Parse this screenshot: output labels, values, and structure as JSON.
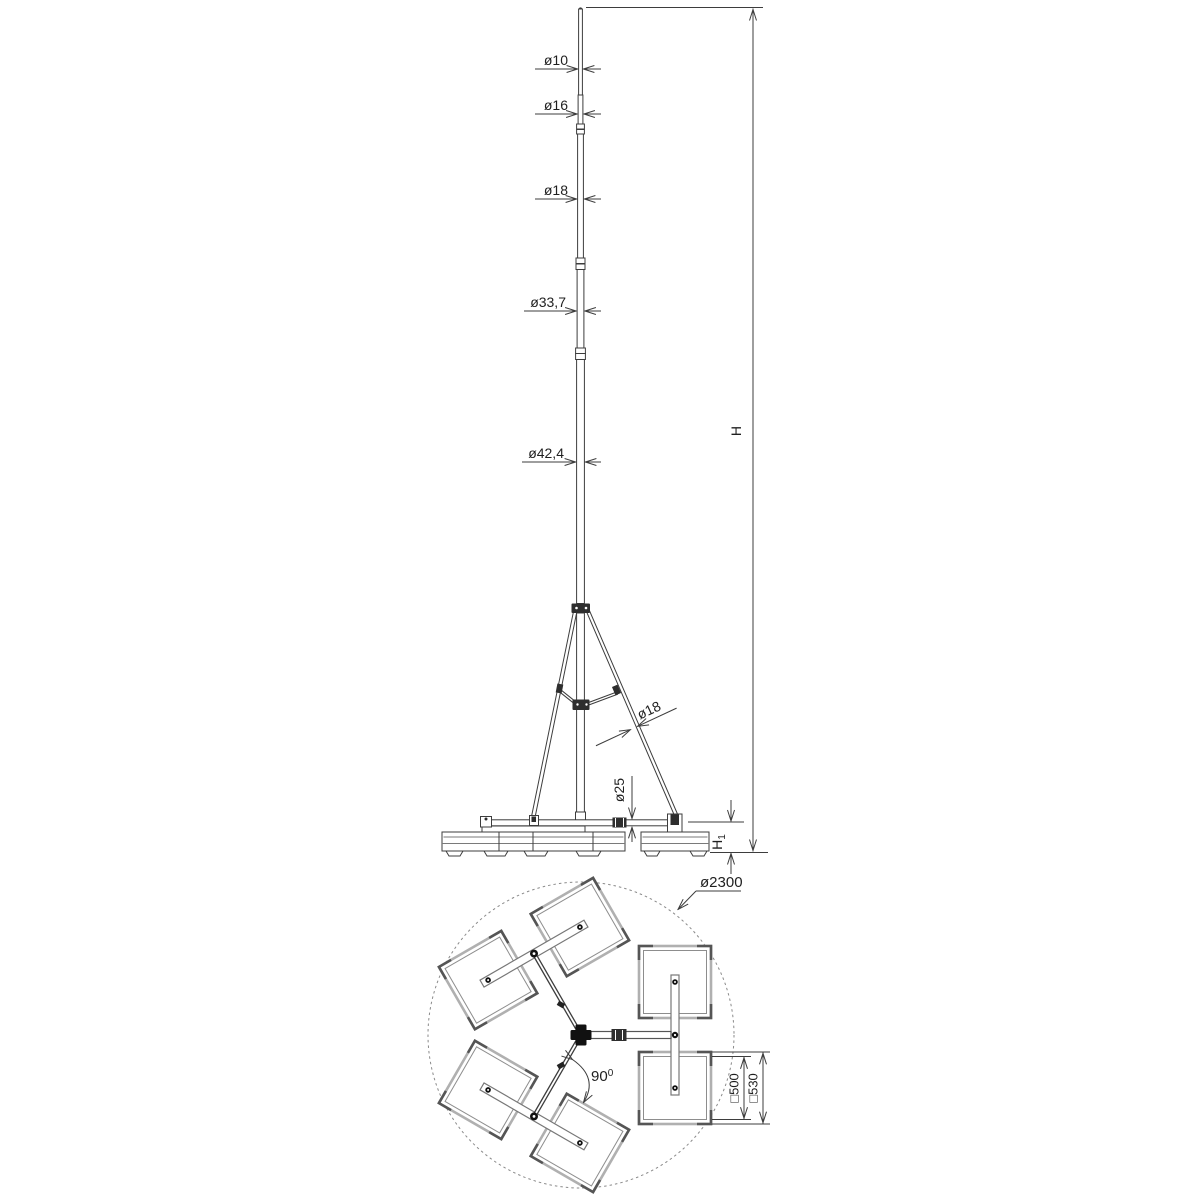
{
  "drawing": {
    "background": "#ffffff",
    "line_color": "#3d3d3d",
    "light_line_color": "#b0b0b0",
    "text_color": "#1f1f1f",
    "views": {
      "elevation": {
        "name": "telescopic-mast-elevation",
        "diameters": {
          "top_section": "ø10",
          "second_section": "ø16",
          "third_section": "ø18",
          "fourth_section": "ø33,7",
          "fifth_section": "ø42,4",
          "tripod_leg": "ø18",
          "base_arm": "ø25"
        },
        "overall_height": {
          "main": "H"
        },
        "base_height": {
          "main": "H",
          "sub": "1"
        }
      },
      "plan": {
        "name": "ballast-base-plan",
        "footprint_diameter": "ø2300",
        "arm_angle": {
          "main": "90",
          "sup": "0"
        },
        "plate_inner": "□500",
        "plate_outer": "□530"
      }
    }
  }
}
